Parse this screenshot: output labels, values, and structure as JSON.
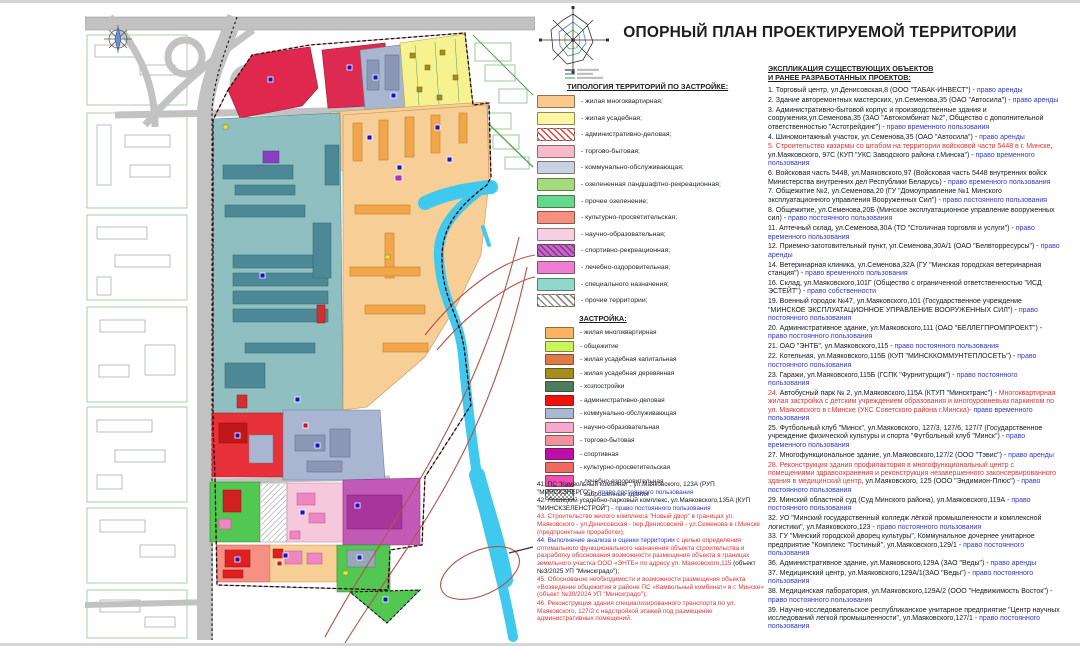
{
  "title": "ОПОРНЫЙ ПЛАН ПРОЕКТИРУЕМОЙ ТЕРРИТОРИИ",
  "typology": {
    "header": "ТИПОЛОГИЯ ТЕРРИТОРИЙ ПО ЗАСТРОЙКЕ:",
    "items": [
      {
        "label": "- жилая многоквартирная;",
        "color": "#FBC98C"
      },
      {
        "label": "- жилая усадебная;",
        "color": "#FDF6A3"
      },
      {
        "label": "- административно-деловая;",
        "color": "#FFFFFF",
        "pattern": "hatch-red"
      },
      {
        "label": "- торгово-бытовая;",
        "color": "#F7B9CB"
      },
      {
        "label": "- коммунально-обслуживающая;",
        "color": "#C9D2E3"
      },
      {
        "label": "- озелененная ландшафтно-рекреационная;",
        "color": "#A4DB7E"
      },
      {
        "label": "- прочее озеленение;",
        "color": "#63D98E"
      },
      {
        "label": "- культурно-просветительская;",
        "color": "#F58F7F"
      },
      {
        "label": "- научно-образовательная;",
        "color": "#F6D0E2"
      },
      {
        "label": "- спортивно-рекреационная;",
        "color": "#C468C8",
        "pattern": "hatch-dark"
      },
      {
        "label": "- лечебно-оздоровительная;",
        "color": "#EC7FD4"
      },
      {
        "label": "- специального назначения;",
        "color": "#8ED8CC"
      },
      {
        "label": "- прочие территории;",
        "color": "#FFFFFF",
        "pattern": "hatch-gray"
      }
    ]
  },
  "development": {
    "header": "ЗАСТРОЙКА:",
    "items": [
      {
        "label": "- жилая многоквартирная",
        "color": "#FBB45F"
      },
      {
        "label": "- общежитие",
        "color": "#C9F25B"
      },
      {
        "label": "- жилая усадебная капитальная",
        "color": "#DD7A45"
      },
      {
        "label": "- жилая усадебная деревянная",
        "color": "#A38E1F"
      },
      {
        "label": "- хозпостройки",
        "color": "#4E7D5E"
      },
      {
        "label": "- административно-деловая",
        "color": "#EF1010"
      },
      {
        "label": "- коммунально-обслуживающая",
        "color": "#A9B9D4"
      },
      {
        "label": "- научно-образовательная",
        "color": "#F6A8CF"
      },
      {
        "label": "- торгово-бытовая",
        "color": "#F2939B"
      },
      {
        "label": "- спортивная",
        "color": "#BE0EA8"
      },
      {
        "label": "- культурно-просветительская",
        "color": "#F26A5E"
      },
      {
        "label": "- лечебно-оздоровительная",
        "color": "#F04FB0"
      },
      {
        "label": "- заброшенные здания",
        "color": "#FFFFFF",
        "pattern": "checker"
      }
    ]
  },
  "notes": {
    "items": [
      {
        "segments": [
          {
            "t": "41. ПС \"Камвольный комбинат\", ул.Маяковского, 123А (РУП \"МИНСКЭНЕРГО\") - ",
            "c": "body"
          },
          {
            "t": "право постоянного пользования",
            "c": "blue"
          }
        ]
      },
      {
        "segments": [
          {
            "t": "42. Лошицкий усадебно-парковый комплекс, ул.Маяковского,135А (КУП \"МИНСКЗЕЛЕНСТРОЙ\") - ",
            "c": "body"
          },
          {
            "t": "право постоянного пользования",
            "c": "blue"
          }
        ]
      },
      {
        "segments": [
          {
            "t": "43. Строительство жилого комплекса \"Новый двор\" в границах ул. Маяковского - ул.Денисовская - пер.Денисовский - ул.Семенова в г.Минске (предпроектные проработки);",
            "c": "red"
          }
        ]
      },
      {
        "segments": [
          {
            "t": "44. Выполнение анализа и оценки территории",
            "c": "blue"
          },
          {
            "t": " с целью определения оптимального функционального назначения объекта строительства и разработку обоснования возможности размещения объекта в границах земельного участка ООО «ЭНТБ» по адресу ул. Маяковского,115 ",
            "c": "red"
          },
          {
            "t": "(объект №3/2025 УП \"Минскградо\");",
            "c": "body"
          }
        ]
      },
      {
        "segments": [
          {
            "t": "45. Обоснование необходимости и возможности размещения объекта «Возведение общежития в районе ПС «Камвольный комбинат» в г. Минске» (объект №30/2024 УП \"Минскградо\");",
            "c": "red"
          }
        ]
      },
      {
        "segments": [
          {
            "t": "46. Реконструкция здания специализированного транспорта по ул. Маяковского, 127/2 с надстройкой этажей под размещение административных помещений.",
            "c": "red"
          }
        ]
      }
    ]
  },
  "explication": {
    "header_line1": "ЭКСПЛИКАЦИЯ СУЩЕСТВУЮЩИХ ОБЪЕКТОВ",
    "header_line2": "И РАНЕЕ РАЗРАБОТАННЫХ ПРОЕКТОВ:",
    "items": [
      {
        "segments": [
          {
            "t": "1. Торговый центр, ул.Денисовская,8 (ООО \"ТАБАК-ИНВЕСТ\") - ",
            "c": "body"
          },
          {
            "t": "право аренды",
            "c": "blue"
          }
        ]
      },
      {
        "segments": [
          {
            "t": "2. Здание авторемонтных мастерских, ул.Семенова,35 (ОАО \"Автосила\") - ",
            "c": "body"
          },
          {
            "t": "право аренды",
            "c": "blue"
          }
        ]
      },
      {
        "segments": [
          {
            "t": "3. Административно-бытовой корпус и производственные здания и сооружения,ул.Семенова,35 (ЗАО \"Автокомбинат №2\", Общество с дополнительной ответственностью \"Астотрейдинг\") - ",
            "c": "body"
          },
          {
            "t": "право временного пользования",
            "c": "blue"
          }
        ]
      },
      {
        "segments": [
          {
            "t": "4. Шиномонтажный участок, ул.Семенова,35 (ОАО \"Автосила\") - ",
            "c": "body"
          },
          {
            "t": "право аренды",
            "c": "blue"
          }
        ]
      },
      {
        "segments": [
          {
            "t": "5. Строительство казармы со штабом на территории войсковой части 5448 в г. Минске",
            "c": "red"
          },
          {
            "t": ", ул.Маяковского, 97С (КУП \"УКС Заводского района г.Минска\") - ",
            "c": "body"
          },
          {
            "t": "право временного пользования",
            "c": "blue"
          }
        ]
      },
      {
        "segments": [
          {
            "t": "6. Войсковая часть 5448, ул.Маяковского,97 (Войсковая часть 5448 внутренних войск Министерства внутренних дел Республики Беларусь) - ",
            "c": "body"
          },
          {
            "t": "право временного пользования",
            "c": "blue"
          }
        ]
      },
      {
        "segments": [
          {
            "t": "7. Общежитие №2, ул.Семенова,20 (ГУ \"Домоуправление №1 Минского эксплуатационного управления Вооруженных Сил\") - ",
            "c": "body"
          },
          {
            "t": "право постоянного пользования",
            "c": "blue"
          }
        ]
      },
      {
        "segments": [
          {
            "t": "8. Общежитие, ул.Семенова,20Б (Минское эксплуатационное управление вооруженных сил) - ",
            "c": "body"
          },
          {
            "t": "право постоянного пользования",
            "c": "blue"
          }
        ]
      },
      {
        "segments": [
          {
            "t": "11. Аптечный склад, ул.Семенова,30А (ТО \"Столичная торговля и услуги\") - ",
            "c": "body"
          },
          {
            "t": "право временного пользования",
            "c": "blue"
          }
        ]
      },
      {
        "segments": [
          {
            "t": "12. Приемно-заготовительный пункт, ул.Семенова,30А/1 (ОАО \"Белвторресурсы\") - ",
            "c": "body"
          },
          {
            "t": "право аренды",
            "c": "blue"
          }
        ]
      },
      {
        "segments": [
          {
            "t": "14. Ветеринарная клиника, ул.Семенова,32А (ГУ \"Минская городская ветеринарная станция\") - ",
            "c": "body"
          },
          {
            "t": "право временного пользования",
            "c": "blue"
          }
        ]
      },
      {
        "segments": [
          {
            "t": "16. Склад, ул.Маяковского,101Г (Общество с ограниченной ответственностью \"ИСД ЭСТЕЙТ\") - ",
            "c": "body"
          },
          {
            "t": "право собственности",
            "c": "blue"
          }
        ]
      },
      {
        "segments": [
          {
            "t": "19. Военный городок №47, ул.Маяковского,101 (Государственное учреждение \"МИНСКОЕ ЭКСПЛУАТАЦИОННОЕ УПРАВЛЕНИЕ ВООРУЖЕННЫХ СИЛ\") - ",
            "c": "body"
          },
          {
            "t": "право постоянного пользования",
            "c": "blue"
          }
        ]
      },
      {
        "segments": [
          {
            "t": "20. Административное здание, ул.Маяковского,111 (ОАО \"БЕЛЛЕГПРОМПРОЕКТ\") - ",
            "c": "body"
          },
          {
            "t": "право постоянного пользования",
            "c": "blue"
          }
        ]
      },
      {
        "segments": [
          {
            "t": "21. ОАО \"ЭНТБ\", ул.Маяковского,115 - ",
            "c": "body"
          },
          {
            "t": "право постоянного пользования",
            "c": "blue"
          }
        ]
      },
      {
        "segments": [
          {
            "t": "22. Котельная, ул.Маяковского,115Б (КУП \"МИНСККОММУНТЕПЛОСЕТЬ\") - ",
            "c": "body"
          },
          {
            "t": "право постоянного пользования",
            "c": "blue"
          }
        ]
      },
      {
        "segments": [
          {
            "t": "23. Гаражи, ул.Маяковского,115Б (ГСПК \"Фурнитурщик\") - ",
            "c": "body"
          },
          {
            "t": "право постоянного пользования",
            "c": "blue"
          }
        ]
      },
      {
        "segments": [
          {
            "t": "24. ",
            "c": "red"
          },
          {
            "t": "Автобусный парк № 2, ул.Маяковского,115А (КТУП \"Минсктранс\") - ",
            "c": "body"
          },
          {
            "t": "Многоквартирная жилая застройка с детским учреждением образования и многоуровневым паркингом по ул. Маяковского в г.Минске (УКС Советского района г.Минска)- ",
            "c": "red"
          },
          {
            "t": "право временного пользования",
            "c": "blue"
          }
        ]
      },
      {
        "segments": [
          {
            "t": "25. Футбольный клуб \"Минск\", ул.Маяковского, 127/3, 127/6, 127/7 (Государственное учреждение физической культуры и спорта \"Футбольный клуб \"Минск\") - ",
            "c": "body"
          },
          {
            "t": "право временного пользования",
            "c": "blue"
          }
        ]
      },
      {
        "segments": [
          {
            "t": "27. Многофункциональное здание, ул.Маяковского,127/2 (ООО \"Тэвис\") - ",
            "c": "body"
          },
          {
            "t": "право аренды",
            "c": "blue"
          }
        ]
      },
      {
        "segments": [
          {
            "t": "28. Реконструкция здания профилактория в многофункциональный центр с помещениями здравоохранения и реконструкция незавершенного законсервированного здания в медицинский центр",
            "c": "red"
          },
          {
            "t": ", ул.Маяковского, 125 (ООО \"Эндимион-Плюс\") ",
            "c": "body"
          },
          {
            "t": "- право постоянного пользования",
            "c": "blue"
          }
        ]
      },
      {
        "segments": [
          {
            "t": "29. Минский областной суд (Суд Минского района), ул.Маяковского,119А - ",
            "c": "body"
          },
          {
            "t": "право постоянного пользования",
            "c": "blue"
          }
        ]
      },
      {
        "segments": [
          {
            "t": "32. УО \"Минский государственный колледж лёгкой промышленности и комплексной логистики\", ул.Маяковского,123 - ",
            "c": "body"
          },
          {
            "t": "право постоянного пользования",
            "c": "blue"
          }
        ]
      },
      {
        "segments": [
          {
            "t": "33. ГУ \"Минский городской дворец культуры\", Коммунальное дочернее унитарное предприятие \"Комплекс \"Гостиный\", ул.Маяковского,129/1 - ",
            "c": "body"
          },
          {
            "t": "право постоянного пользования",
            "c": "blue"
          }
        ]
      },
      {
        "segments": [
          {
            "t": "36. Административное здание, ул.Маяковского,129А (ЗАО \"Веды\") - ",
            "c": "body"
          },
          {
            "t": "право аренды",
            "c": "blue"
          }
        ]
      },
      {
        "segments": [
          {
            "t": "37. Медицинский центр, ул.Маяковского,129А/1(ЗАО \"Веды\") - ",
            "c": "body"
          },
          {
            "t": "право постоянного пользования",
            "c": "blue"
          }
        ]
      },
      {
        "segments": [
          {
            "t": "38. Медицинская лаборатория, ул.Маяковского,129А/2 (ООО \"Недвижимость Восток\") - ",
            "c": "body"
          },
          {
            "t": "право постоянного пользования",
            "c": "blue"
          }
        ]
      },
      {
        "segments": [
          {
            "t": "39. Научно-исследовательское республиканское унитарное предприятие \"Центр научных исследований легкой промышленности\", ул.Маяковского,127/1 - ",
            "c": "body"
          },
          {
            "t": "право постоянного пользования",
            "c": "blue"
          }
        ]
      }
    ]
  },
  "colors": {
    "body_text": "#141821",
    "rights_blue": "#3038CC",
    "special_red": "#E03535",
    "river": "#3FC9EE",
    "project_boundary": "#111111"
  }
}
